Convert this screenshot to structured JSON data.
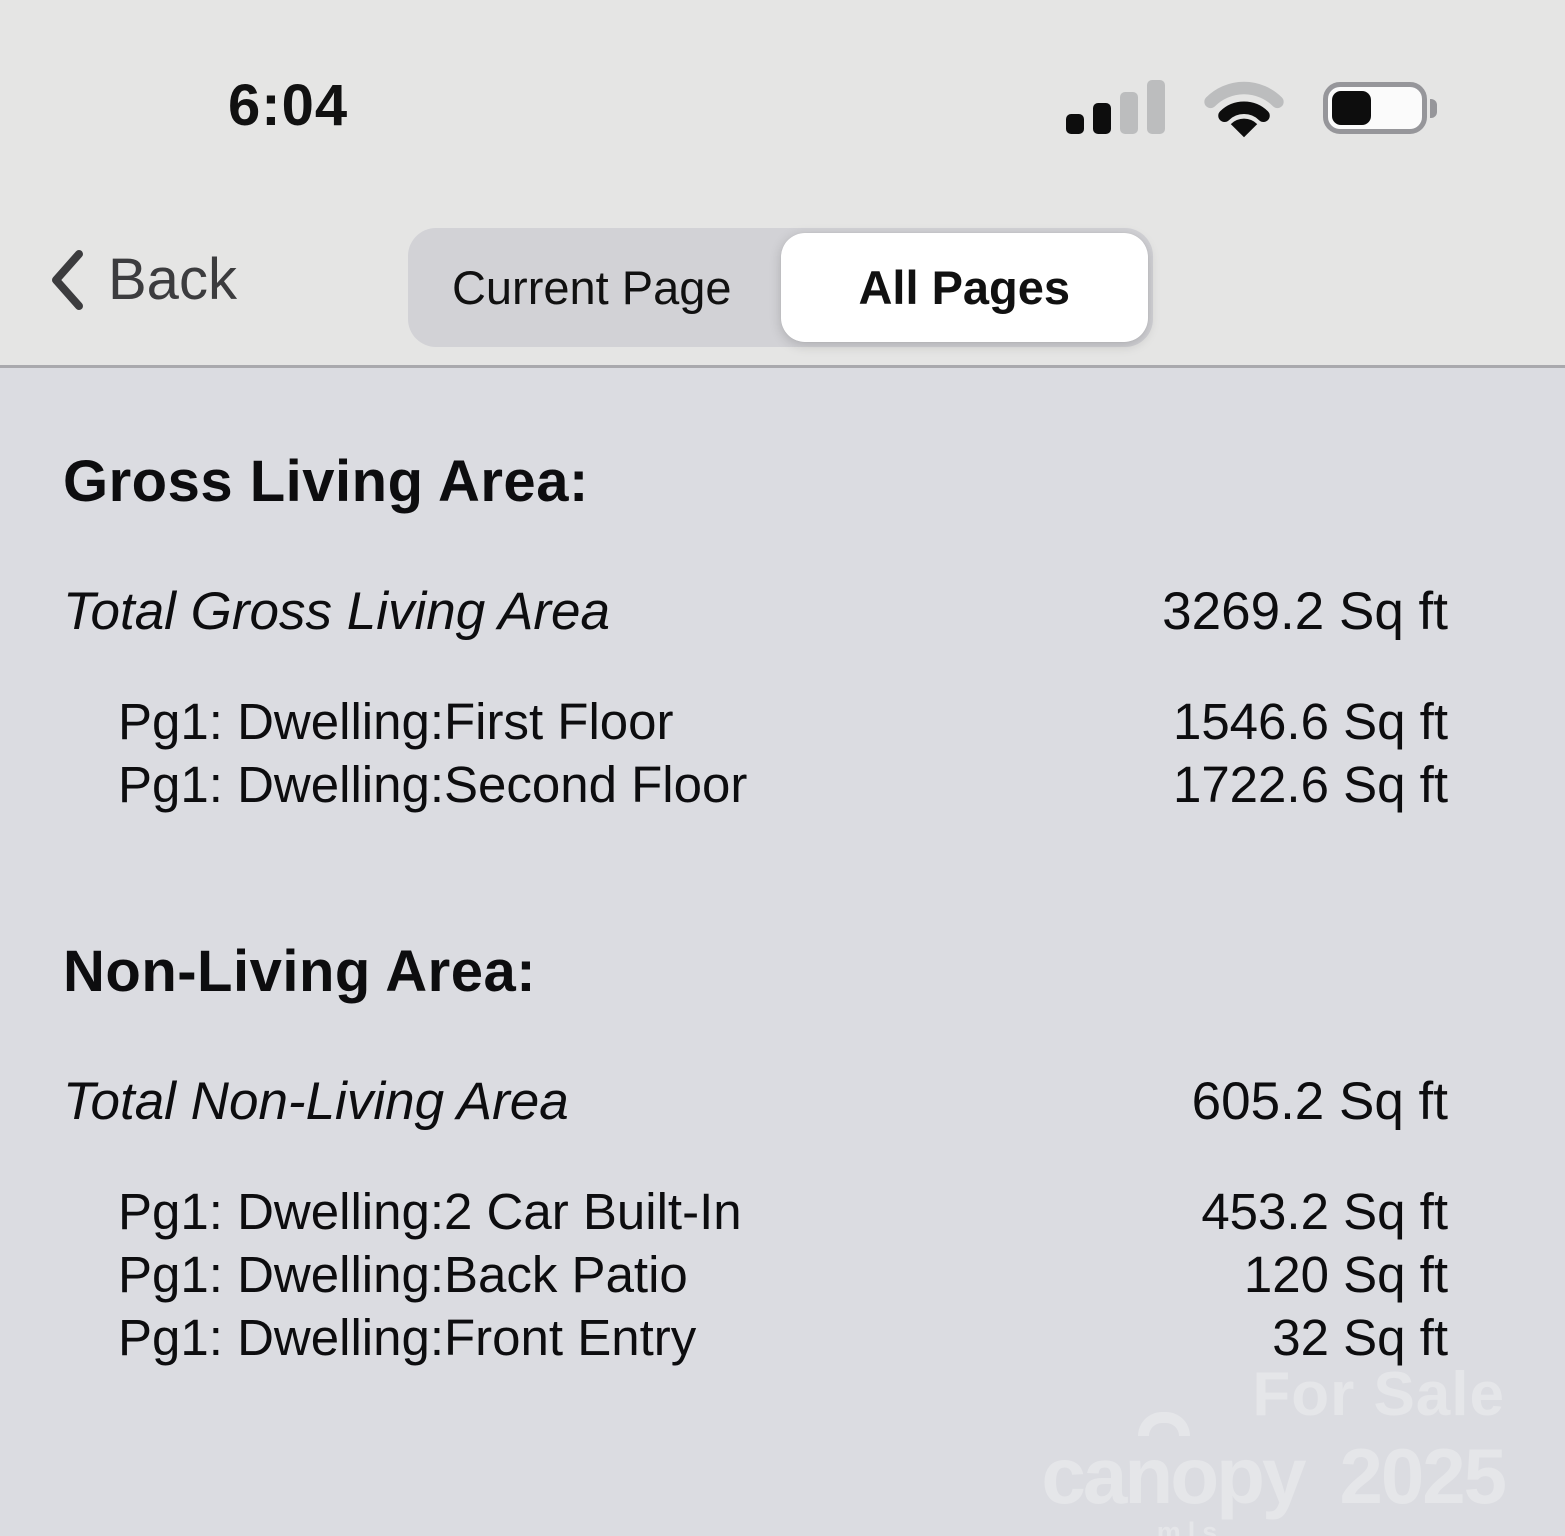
{
  "status_bar": {
    "time": "6:04",
    "signal_bars_filled": 2,
    "signal_bars_total": 4,
    "wifi_strength": "2-of-3",
    "battery_percent": 45
  },
  "nav": {
    "back_label": "Back",
    "segments": [
      {
        "label": "Current Page",
        "selected": false
      },
      {
        "label": "All Pages",
        "selected": true
      }
    ]
  },
  "sections": [
    {
      "heading": "Gross Living Area:",
      "total_label": "Total Gross Living Area",
      "total_value": "3269.2 Sq ft",
      "rows": [
        {
          "label": "Pg1: Dwelling:First Floor",
          "value": "1546.6 Sq ft"
        },
        {
          "label": "Pg1: Dwelling:Second Floor",
          "value": "1722.6 Sq ft"
        }
      ]
    },
    {
      "heading": "Non-Living Area:",
      "total_label": "Total Non-Living Area",
      "total_value": "605.2 Sq ft",
      "rows": [
        {
          "label": "Pg1: Dwelling:2 Car Built-In",
          "value": "453.2 Sq ft"
        },
        {
          "label": "Pg1: Dwelling:Back Patio",
          "value": "120 Sq ft"
        },
        {
          "label": "Pg1: Dwelling:Front Entry",
          "value": "32 Sq ft"
        }
      ]
    }
  ],
  "watermark": {
    "line1": "For Sale",
    "brand": "canopy",
    "brand_sub": "MLS",
    "year": "2025"
  },
  "colors": {
    "header_bg": "#e5e5e4",
    "content_bg": "#dbdce1",
    "divider": "#a9a9ad",
    "segment_control_bg": "#d2d2d6",
    "segment_selected_bg": "#ffffff",
    "text": "#0d0d0f",
    "back_text": "#3c3c3e",
    "watermark": "#e5e6e9"
  }
}
